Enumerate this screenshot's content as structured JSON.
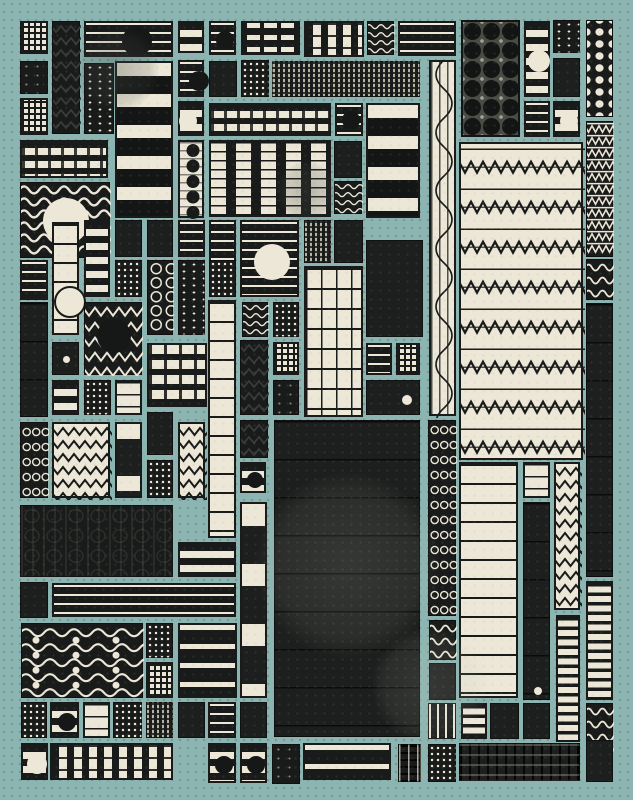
{
  "canvas": {
    "width": 633,
    "height": 800,
    "background": "#8cb4b0",
    "dot_grid_color": "#3a5c58"
  },
  "palette": {
    "ink": "#191b1a",
    "dark": "#1d1f1e",
    "cream": "#ece7d7",
    "teal": "#8cb4b0",
    "dim": "#393b39"
  },
  "tiles": [
    {
      "x": 20,
      "y": 21,
      "w": 28,
      "h": 33,
      "p": "fg"
    },
    {
      "x": 52,
      "y": 21,
      "w": 28,
      "h": 113,
      "p": "zzd"
    },
    {
      "x": 84,
      "y": 21,
      "w": 89,
      "h": 36,
      "p": "hd",
      "c": [
        0.57,
        0.5,
        15,
        "ink"
      ]
    },
    {
      "x": 178,
      "y": 21,
      "w": 26,
      "h": 32,
      "p": "hb"
    },
    {
      "x": 209,
      "y": 21,
      "w": 27,
      "h": 34,
      "p": "hd",
      "c": [
        0.5,
        0.5,
        9,
        "ink"
      ]
    },
    {
      "x": 241,
      "y": 21,
      "w": 59,
      "h": 34,
      "p": "blk2"
    },
    {
      "x": 304,
      "y": 21,
      "w": 60,
      "h": 36,
      "p": "vwe"
    },
    {
      "x": 367,
      "y": 21,
      "w": 27,
      "h": 34,
      "p": "wvf"
    },
    {
      "x": 398,
      "y": 21,
      "w": 58,
      "h": 35,
      "p": "hd"
    },
    {
      "x": 461,
      "y": 20,
      "w": 59,
      "h": 117,
      "p": "bd"
    },
    {
      "x": 524,
      "y": 21,
      "w": 26,
      "h": 76,
      "p": "hb",
      "c": [
        0.5,
        0.5,
        11,
        "cream"
      ]
    },
    {
      "x": 553,
      "y": 20,
      "w": 27,
      "h": 33,
      "p": "vd"
    },
    {
      "x": 586,
      "y": 20,
      "w": 27,
      "h": 97,
      "p": "pd"
    },
    {
      "x": 20,
      "y": 61,
      "w": 28,
      "h": 33,
      "p": "dsp"
    },
    {
      "x": 84,
      "y": 63,
      "w": 30,
      "h": 71,
      "p": "vd"
    },
    {
      "x": 115,
      "y": 61,
      "w": 58,
      "h": 157,
      "p": "hbw"
    },
    {
      "x": 178,
      "y": 60,
      "w": 26,
      "h": 37,
      "p": "hd",
      "c": [
        0.72,
        0.5,
        10,
        "ink"
      ]
    },
    {
      "x": 209,
      "y": 61,
      "w": 28,
      "h": 36,
      "p": "dd"
    },
    {
      "x": 241,
      "y": 60,
      "w": 28,
      "h": 37,
      "p": "fgd"
    },
    {
      "x": 272,
      "y": 61,
      "w": 148,
      "h": 36,
      "p": "wef"
    },
    {
      "x": 553,
      "y": 58,
      "w": 27,
      "h": 39,
      "p": "dd"
    },
    {
      "x": 429,
      "y": 60,
      "w": 27,
      "h": 356,
      "p": "sv"
    },
    {
      "x": 20,
      "y": 98,
      "w": 28,
      "h": 37,
      "p": "fg"
    },
    {
      "x": 178,
      "y": 101,
      "w": 26,
      "h": 35,
      "p": "hb",
      "c": [
        0.3,
        0.5,
        9,
        "cream"
      ]
    },
    {
      "x": 209,
      "y": 103,
      "w": 122,
      "h": 33,
      "p": "we"
    },
    {
      "x": 335,
      "y": 103,
      "w": 28,
      "h": 33,
      "p": "hd",
      "c": [
        0.5,
        0.45,
        9,
        "ink"
      ]
    },
    {
      "x": 366,
      "y": 103,
      "w": 54,
      "h": 115,
      "p": "hbw"
    },
    {
      "x": 524,
      "y": 101,
      "w": 26,
      "h": 36,
      "p": "hd"
    },
    {
      "x": 553,
      "y": 101,
      "w": 27,
      "h": 36,
      "p": "hb",
      "c": [
        0.5,
        0.5,
        9,
        "cream"
      ]
    },
    {
      "x": 586,
      "y": 121,
      "w": 27,
      "h": 136,
      "p": "zb"
    },
    {
      "x": 20,
      "y": 140,
      "w": 88,
      "h": 38,
      "p": "we"
    },
    {
      "x": 20,
      "y": 182,
      "w": 90,
      "h": 76,
      "p": "wv",
      "c": [
        0.5,
        0.5,
        23,
        "cream"
      ]
    },
    {
      "x": 178,
      "y": 140,
      "w": 26,
      "h": 78,
      "p": "beads"
    },
    {
      "x": 209,
      "y": 140,
      "w": 122,
      "h": 77,
      "p": "vdc"
    },
    {
      "x": 334,
      "y": 141,
      "w": 28,
      "h": 37,
      "p": "dd"
    },
    {
      "x": 334,
      "y": 181,
      "w": 28,
      "h": 33,
      "p": "wvf"
    },
    {
      "x": 459,
      "y": 142,
      "w": 124,
      "h": 318,
      "p": "wzb"
    },
    {
      "x": 115,
      "y": 220,
      "w": 27,
      "h": 37,
      "p": "dd"
    },
    {
      "x": 147,
      "y": 220,
      "w": 26,
      "h": 37,
      "p": "dd"
    },
    {
      "x": 84,
      "y": 220,
      "w": 26,
      "h": 77,
      "p": "hb"
    },
    {
      "x": 52,
      "y": 222,
      "w": 27,
      "h": 113,
      "p": "hct",
      "c": [
        0.5,
        0.67,
        14,
        "outline"
      ]
    },
    {
      "x": 178,
      "y": 220,
      "w": 27,
      "h": 37,
      "p": "hd"
    },
    {
      "x": 209,
      "y": 220,
      "w": 27,
      "h": 43,
      "p": "hd"
    },
    {
      "x": 240,
      "y": 220,
      "w": 59,
      "h": 77,
      "p": "hd",
      "c": [
        0.5,
        0.52,
        18,
        "cream"
      ]
    },
    {
      "x": 304,
      "y": 220,
      "w": 27,
      "h": 43,
      "p": "wef"
    },
    {
      "x": 334,
      "y": 220,
      "w": 29,
      "h": 43,
      "p": "dd"
    },
    {
      "x": 20,
      "y": 260,
      "w": 28,
      "h": 40,
      "p": "hd"
    },
    {
      "x": 115,
      "y": 260,
      "w": 27,
      "h": 37,
      "p": "fgd"
    },
    {
      "x": 147,
      "y": 260,
      "w": 26,
      "h": 75,
      "p": "rings"
    },
    {
      "x": 178,
      "y": 260,
      "w": 27,
      "h": 75,
      "p": "vd"
    },
    {
      "x": 209,
      "y": 260,
      "w": 27,
      "h": 37,
      "p": "fgd"
    },
    {
      "x": 366,
      "y": 240,
      "w": 57,
      "h": 97,
      "p": "dd"
    },
    {
      "x": 304,
      "y": 266,
      "w": 59,
      "h": 151,
      "p": "cg"
    },
    {
      "x": 586,
      "y": 259,
      "w": 27,
      "h": 41,
      "p": "wvs"
    },
    {
      "x": 20,
      "y": 302,
      "w": 28,
      "h": 115,
      "p": "ddl"
    },
    {
      "x": 84,
      "y": 302,
      "w": 58,
      "h": 73,
      "p": "zd",
      "c": [
        0.5,
        0.45,
        17,
        "ink"
      ]
    },
    {
      "x": 242,
      "y": 302,
      "w": 26,
      "h": 35,
      "p": "wvf"
    },
    {
      "x": 273,
      "y": 302,
      "w": 26,
      "h": 35,
      "p": "fgd"
    },
    {
      "x": 208,
      "y": 300,
      "w": 28,
      "h": 238,
      "p": "hct"
    },
    {
      "x": 52,
      "y": 342,
      "w": 27,
      "h": 33,
      "p": "dd",
      "c": [
        0.5,
        0.5,
        3.5,
        "cream"
      ]
    },
    {
      "x": 147,
      "y": 343,
      "w": 60,
      "h": 64,
      "p": "blk"
    },
    {
      "x": 240,
      "y": 340,
      "w": 28,
      "h": 75,
      "p": "zzd"
    },
    {
      "x": 273,
      "y": 342,
      "w": 26,
      "h": 33,
      "p": "fg"
    },
    {
      "x": 366,
      "y": 343,
      "w": 26,
      "h": 32,
      "p": "hd"
    },
    {
      "x": 396,
      "y": 343,
      "w": 24,
      "h": 32,
      "p": "fg"
    },
    {
      "x": 273,
      "y": 380,
      "w": 26,
      "h": 35,
      "p": "dsp"
    },
    {
      "x": 366,
      "y": 380,
      "w": 54,
      "h": 35,
      "p": "dd",
      "c": [
        0.74,
        0.55,
        5,
        "cream"
      ]
    },
    {
      "x": 52,
      "y": 380,
      "w": 27,
      "h": 35,
      "p": "hb"
    },
    {
      "x": 84,
      "y": 380,
      "w": 27,
      "h": 35,
      "p": "fgd"
    },
    {
      "x": 115,
      "y": 380,
      "w": 27,
      "h": 35,
      "p": "hc"
    },
    {
      "x": 586,
      "y": 303,
      "w": 27,
      "h": 274,
      "p": "ddl"
    },
    {
      "x": 20,
      "y": 422,
      "w": 28,
      "h": 76,
      "p": "chain"
    },
    {
      "x": 52,
      "y": 422,
      "w": 58,
      "h": 76,
      "p": "wz"
    },
    {
      "x": 115,
      "y": 422,
      "w": 27,
      "h": 76,
      "p": "vbk"
    },
    {
      "x": 147,
      "y": 412,
      "w": 26,
      "h": 43,
      "p": "dd"
    },
    {
      "x": 178,
      "y": 422,
      "w": 27,
      "h": 76,
      "p": "wz"
    },
    {
      "x": 240,
      "y": 420,
      "w": 28,
      "h": 38,
      "p": "zzd"
    },
    {
      "x": 274,
      "y": 420,
      "w": 146,
      "h": 317,
      "p": "ddb"
    },
    {
      "x": 428,
      "y": 420,
      "w": 28,
      "h": 196,
      "p": "chain"
    },
    {
      "x": 147,
      "y": 460,
      "w": 26,
      "h": 38,
      "p": "fgd"
    },
    {
      "x": 240,
      "y": 462,
      "w": 26,
      "h": 31,
      "p": "hb",
      "c": [
        0.5,
        0.5,
        8,
        "ink"
      ]
    },
    {
      "x": 459,
      "y": 462,
      "w": 59,
      "h": 236,
      "p": "hct"
    },
    {
      "x": 523,
      "y": 462,
      "w": 27,
      "h": 36,
      "p": "hc"
    },
    {
      "x": 554,
      "y": 462,
      "w": 26,
      "h": 148,
      "p": "wz"
    },
    {
      "x": 240,
      "y": 502,
      "w": 27,
      "h": 196,
      "p": "vbl"
    },
    {
      "x": 523,
      "y": 502,
      "w": 27,
      "h": 198,
      "p": "ddl",
      "c": [
        0.5,
        0.95,
        4,
        "cream"
      ]
    },
    {
      "x": 20,
      "y": 505,
      "w": 153,
      "h": 72,
      "p": "bwd"
    },
    {
      "x": 178,
      "y": 542,
      "w": 58,
      "h": 35,
      "p": "hb"
    },
    {
      "x": 20,
      "y": 582,
      "w": 28,
      "h": 36,
      "p": "dd"
    },
    {
      "x": 52,
      "y": 583,
      "w": 184,
      "h": 34,
      "p": "hd"
    },
    {
      "x": 586,
      "y": 581,
      "w": 27,
      "h": 119,
      "p": "hcd"
    },
    {
      "x": 429,
      "y": 620,
      "w": 27,
      "h": 40,
      "p": "wvs"
    },
    {
      "x": 21,
      "y": 623,
      "w": 122,
      "h": 75,
      "p": "wvw"
    },
    {
      "x": 146,
      "y": 623,
      "w": 27,
      "h": 35,
      "p": "fgd"
    },
    {
      "x": 178,
      "y": 623,
      "w": 59,
      "h": 75,
      "p": "hd2"
    },
    {
      "x": 556,
      "y": 615,
      "w": 24,
      "h": 127,
      "p": "hcd"
    },
    {
      "x": 146,
      "y": 662,
      "w": 27,
      "h": 36,
      "p": "fg"
    },
    {
      "x": 429,
      "y": 663,
      "w": 27,
      "h": 37,
      "p": "dd"
    },
    {
      "x": 523,
      "y": 703,
      "w": 27,
      "h": 36,
      "p": "dd"
    },
    {
      "x": 21,
      "y": 702,
      "w": 26,
      "h": 36,
      "p": "fgd"
    },
    {
      "x": 50,
      "y": 702,
      "w": 29,
      "h": 36,
      "p": "hb",
      "c": [
        0.5,
        0.5,
        9,
        "ink"
      ]
    },
    {
      "x": 83,
      "y": 702,
      "w": 27,
      "h": 36,
      "p": "hc"
    },
    {
      "x": 113,
      "y": 702,
      "w": 29,
      "h": 36,
      "p": "fgd"
    },
    {
      "x": 146,
      "y": 702,
      "w": 27,
      "h": 36,
      "p": "wef"
    },
    {
      "x": 178,
      "y": 702,
      "w": 27,
      "h": 36,
      "p": "dd"
    },
    {
      "x": 208,
      "y": 702,
      "w": 28,
      "h": 36,
      "p": "hd"
    },
    {
      "x": 240,
      "y": 702,
      "w": 27,
      "h": 36,
      "p": "dd"
    },
    {
      "x": 428,
      "y": 703,
      "w": 28,
      "h": 36,
      "p": "vbf"
    },
    {
      "x": 461,
      "y": 703,
      "w": 26,
      "h": 36,
      "p": "hcd"
    },
    {
      "x": 490,
      "y": 703,
      "w": 29,
      "h": 36,
      "p": "dd"
    },
    {
      "x": 586,
      "y": 703,
      "w": 27,
      "h": 55,
      "p": "wvs"
    },
    {
      "x": 21,
      "y": 743,
      "w": 27,
      "h": 37,
      "p": "hb",
      "c": [
        0.5,
        0.5,
        10,
        "cream"
      ]
    },
    {
      "x": 50,
      "y": 743,
      "w": 123,
      "h": 37,
      "p": "vwe"
    },
    {
      "x": 208,
      "y": 743,
      "w": 28,
      "h": 40,
      "p": "hb",
      "c": [
        0.5,
        0.5,
        9,
        "ink"
      ]
    },
    {
      "x": 240,
      "y": 743,
      "w": 27,
      "h": 40,
      "p": "hb",
      "c": [
        0.5,
        0.5,
        9,
        "ink"
      ]
    },
    {
      "x": 272,
      "y": 744,
      "w": 28,
      "h": 40,
      "p": "dsp"
    },
    {
      "x": 303,
      "y": 743,
      "w": 88,
      "h": 37,
      "p": "hd2"
    },
    {
      "x": 398,
      "y": 744,
      "w": 23,
      "h": 38,
      "p": "vdl"
    },
    {
      "x": 428,
      "y": 744,
      "w": 28,
      "h": 38,
      "p": "fgd"
    },
    {
      "x": 459,
      "y": 743,
      "w": 121,
      "h": 38,
      "p": "ddr"
    },
    {
      "x": 586,
      "y": 740,
      "w": 27,
      "h": 42,
      "p": "dd"
    }
  ],
  "smudges": [
    {
      "cx": 117,
      "cy": 70,
      "r": 42,
      "tone": "dark"
    },
    {
      "cx": 307,
      "cy": 192,
      "r": 31,
      "tone": "dark"
    },
    {
      "cx": 348,
      "cy": 565,
      "r": 92,
      "tone": "light"
    },
    {
      "cx": 430,
      "cy": 686,
      "r": 58,
      "tone": "light"
    }
  ]
}
